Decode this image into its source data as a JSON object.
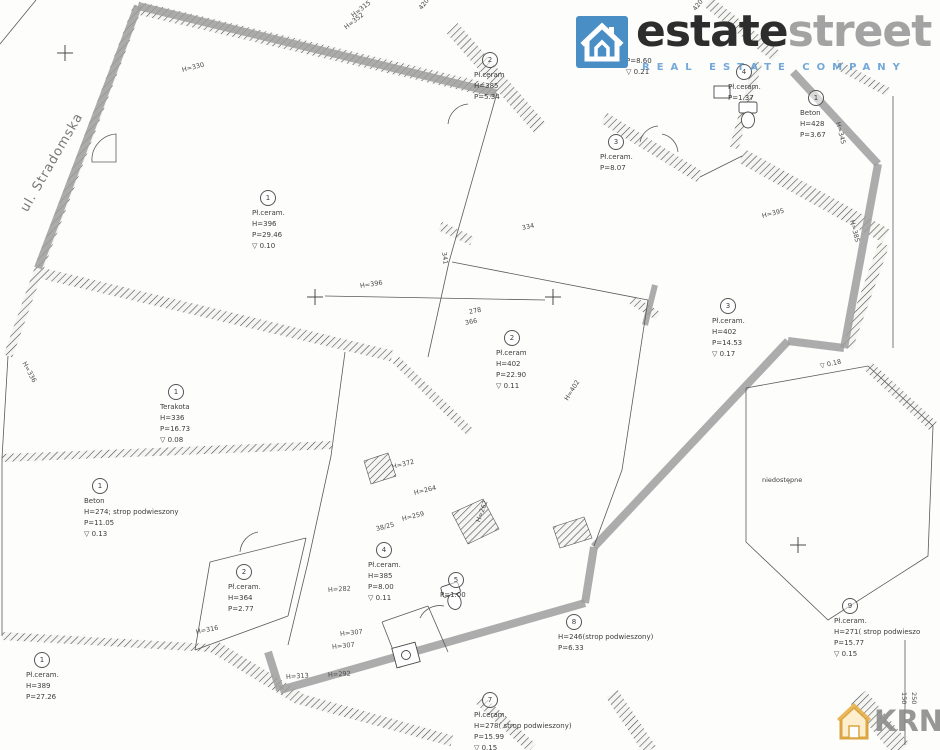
{
  "branding": {
    "estatestreet": {
      "word_primary": "estate",
      "word_secondary": "street",
      "tagline": "REAL ESTATE COMPANY",
      "brand_blue": "#4a8ec6",
      "word_primary_color": "#2d2d2d",
      "word_secondary_color": "#a3a3a3"
    },
    "krn": {
      "name": "KRN",
      "suffix": ".pl",
      "text_color": "#8c8c8c",
      "icon_color": "#d89c2e"
    }
  },
  "plan": {
    "street_label": "ul. Stradomska",
    "inaccessible_label": "niedostępne",
    "highlight_color": "#9e9e9e",
    "rooms": [
      {
        "number": "1",
        "lines": [
          "Pł.ceram.",
          "H=396",
          "P=29.46",
          "▽ 0.10"
        ],
        "x": 252,
        "y": 190
      },
      {
        "number": "2",
        "lines": [
          "Pł.ceram",
          "H=385",
          "P=5.34"
        ],
        "x": 474,
        "y": 52
      },
      {
        "number": null,
        "lines": [
          "P=8.60",
          "▽ 0.21"
        ],
        "x": 626,
        "y": 56
      },
      {
        "number": "3",
        "lines": [
          "Pł.ceram.",
          "P=8.07"
        ],
        "x": 600,
        "y": 134
      },
      {
        "number": "4",
        "lines": [
          "Pł.ceram.",
          "P=1.37"
        ],
        "x": 728,
        "y": 64
      },
      {
        "number": "1",
        "lines": [
          "Beton",
          "H=428",
          "P=3.67"
        ],
        "x": 800,
        "y": 90
      },
      {
        "number": "2",
        "lines": [
          "Pł.ceram",
          "H=402",
          "P=22.90",
          "▽ 0.11"
        ],
        "x": 496,
        "y": 330
      },
      {
        "number": "3",
        "lines": [
          "Pł.ceram.",
          "H=402",
          "P=14.53",
          "▽ 0.17"
        ],
        "x": 712,
        "y": 298
      },
      {
        "number": "1",
        "lines": [
          "Terakota",
          "H=336",
          "P=16.73",
          "▽ 0.08"
        ],
        "x": 160,
        "y": 384
      },
      {
        "number": "1",
        "lines": [
          "Beton",
          "H=274; strop podwieszony",
          "P=11.05",
          "▽ 0.13"
        ],
        "x": 84,
        "y": 478
      },
      {
        "number": "2",
        "lines": [
          "Pł.ceram.",
          "H=364",
          "P=2.77"
        ],
        "x": 228,
        "y": 564
      },
      {
        "number": "1",
        "lines": [
          "Pł.ceram.",
          "H=389",
          "P=27.26"
        ],
        "x": 26,
        "y": 652
      },
      {
        "number": "4",
        "lines": [
          "Pł.ceram.",
          "H=385",
          "P=8.00",
          "▽ 0.11"
        ],
        "x": 368,
        "y": 542
      },
      {
        "number": "5",
        "lines": [
          "P=1.00"
        ],
        "x": 440,
        "y": 572
      },
      {
        "number": "8",
        "lines": [
          "H=246(strop podwieszony)",
          "P=6.33"
        ],
        "x": 558,
        "y": 614
      },
      {
        "number": "9",
        "lines": [
          "Pł.ceram.",
          "H=271( strop podwieszo",
          "P=15.77",
          "▽ 0.15"
        ],
        "x": 834,
        "y": 598
      },
      {
        "number": "7",
        "lines": [
          "Pł.ceram.",
          "H=278( strop podwieszony)",
          "P=15.99",
          "▽ 0.15"
        ],
        "x": 474,
        "y": 692
      }
    ],
    "dimensions": [
      {
        "text": "H=315",
        "x": 352,
        "y": 12,
        "rot": -38
      },
      {
        "text": "H=352",
        "x": 345,
        "y": 24,
        "rot": -38
      },
      {
        "text": "420",
        "x": 420,
        "y": 5,
        "rot": -52
      },
      {
        "text": "420",
        "x": 694,
        "y": 6,
        "rot": -52
      },
      {
        "text": "H=330",
        "x": 182,
        "y": 66,
        "rot": -14
      },
      {
        "text": "341",
        "x": 444,
        "y": 248,
        "rot": 82
      },
      {
        "text": "334",
        "x": 522,
        "y": 224,
        "rot": -12
      },
      {
        "text": "H=396",
        "x": 360,
        "y": 282,
        "rot": -9
      },
      {
        "text": "278",
        "x": 469,
        "y": 308,
        "rot": -11
      },
      {
        "text": "366",
        "x": 465,
        "y": 319,
        "rot": -11
      },
      {
        "text": "H=402",
        "x": 566,
        "y": 396,
        "rot": -58
      },
      {
        "text": "H=336",
        "x": 24,
        "y": 358,
        "rot": 62
      },
      {
        "text": "H=345",
        "x": 838,
        "y": 118,
        "rot": 76
      },
      {
        "text": "H=395",
        "x": 762,
        "y": 212,
        "rot": -14
      },
      {
        "text": "H=385",
        "x": 852,
        "y": 216,
        "rot": 76
      },
      {
        "text": "▽ 0.18",
        "x": 820,
        "y": 362,
        "rot": -12
      },
      {
        "text": "H=316",
        "x": 196,
        "y": 628,
        "rot": -11
      },
      {
        "text": "H=282",
        "x": 328,
        "y": 586,
        "rot": -4
      },
      {
        "text": "H=307",
        "x": 340,
        "y": 630,
        "rot": -6
      },
      {
        "text": "H=307",
        "x": 332,
        "y": 643,
        "rot": -6
      },
      {
        "text": "H=313",
        "x": 286,
        "y": 673,
        "rot": -4
      },
      {
        "text": "H=292",
        "x": 328,
        "y": 671,
        "rot": -4
      },
      {
        "text": "H=372",
        "x": 392,
        "y": 463,
        "rot": -14
      },
      {
        "text": "H=264",
        "x": 414,
        "y": 489,
        "rot": -14
      },
      {
        "text": "H=259",
        "x": 402,
        "y": 515,
        "rot": -14
      },
      {
        "text": "38/25",
        "x": 376,
        "y": 525,
        "rot": -14
      },
      {
        "text": "H=262",
        "x": 478,
        "y": 518,
        "rot": -70
      },
      {
        "text": "150",
        "x": 904,
        "y": 688,
        "rot": 90
      },
      {
        "text": "250",
        "x": 914,
        "y": 688,
        "rot": 90
      }
    ]
  }
}
